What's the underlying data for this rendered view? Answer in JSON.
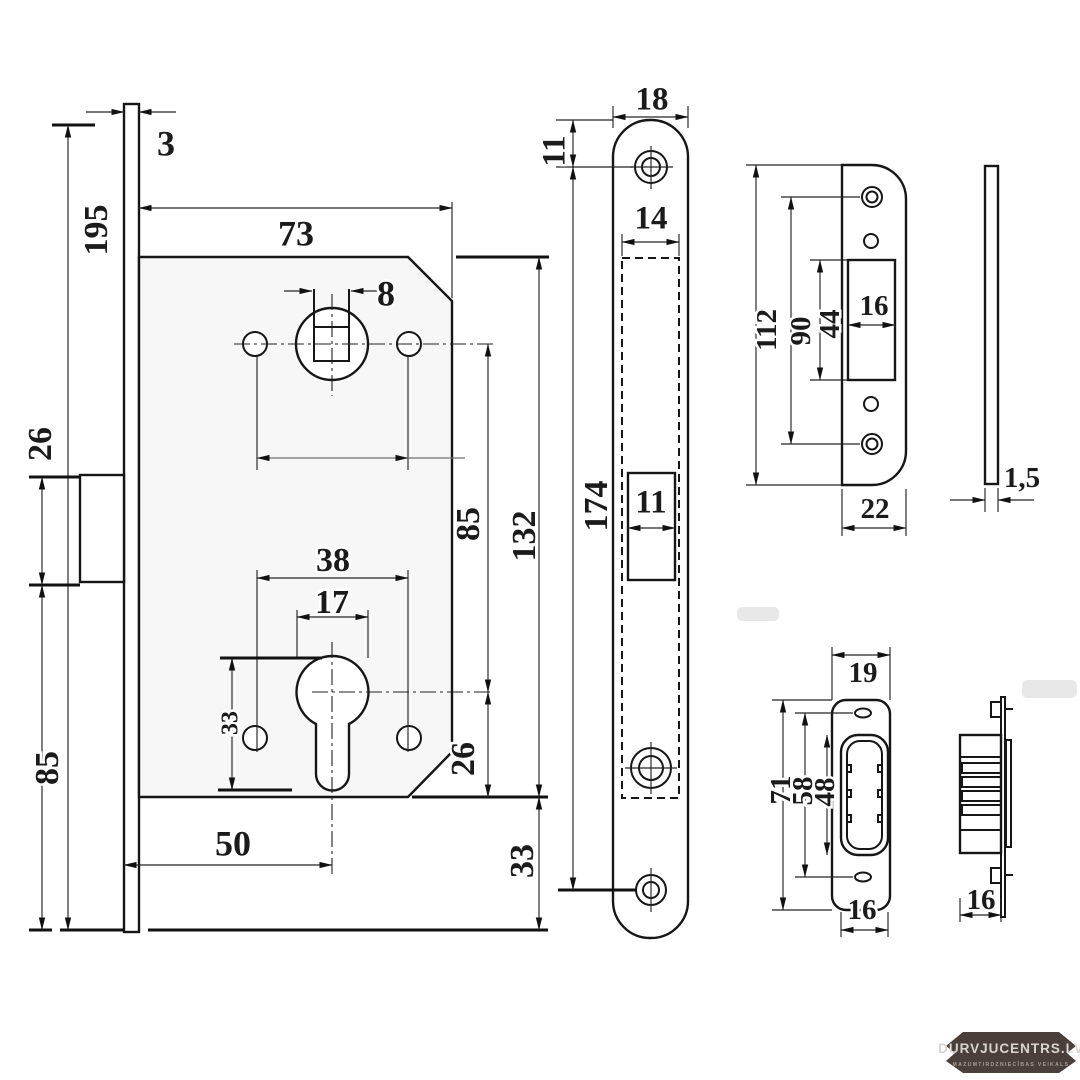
{
  "colors": {
    "line": "#161616",
    "dim_text": "#1b1b1b",
    "body_fill": "#f7f7f7",
    "badge_bg": "#4a403b",
    "badge_text": "#d9d5d1",
    "badge_tagline": "#a89f9a"
  },
  "views": {
    "lock_front": {
      "faceplate_thickness": "3",
      "faceplate_height": "195",
      "body_width": "73",
      "spindle_square": "8",
      "latch_height": "26",
      "latch_to_bottom": "85",
      "holes_spacing_unlabeled": "",
      "lower_holes_spacing": "38",
      "cylinder_diameter": "17",
      "cylinder_cutout_height": "33",
      "backset": "50",
      "centers_distance": "85",
      "body_height": "132",
      "cylinder_to_body_bottom": "26",
      "body_bottom_to_plate_end": "33"
    },
    "faceplate_front": {
      "width": "18",
      "top_to_screw": "11",
      "inner_width": "14",
      "latch_opening_width": "11",
      "screw_centers": "174"
    },
    "strike_plate": {
      "height": "112",
      "screw_centers": "90",
      "cutout_height": "44",
      "cutout_width": "16",
      "width": "22",
      "thickness": "1,5"
    },
    "strike_box_front": {
      "top_width": "19",
      "height": "71",
      "screw_centers": "58",
      "opening_height": "48",
      "opening_width": "16"
    },
    "strike_box_side": {
      "depth": "16"
    }
  },
  "logo": {
    "title": "DURVJUCENTRS.LV",
    "tagline": "MAZUMTIRDZNIECĪBAS VEIKALS"
  }
}
